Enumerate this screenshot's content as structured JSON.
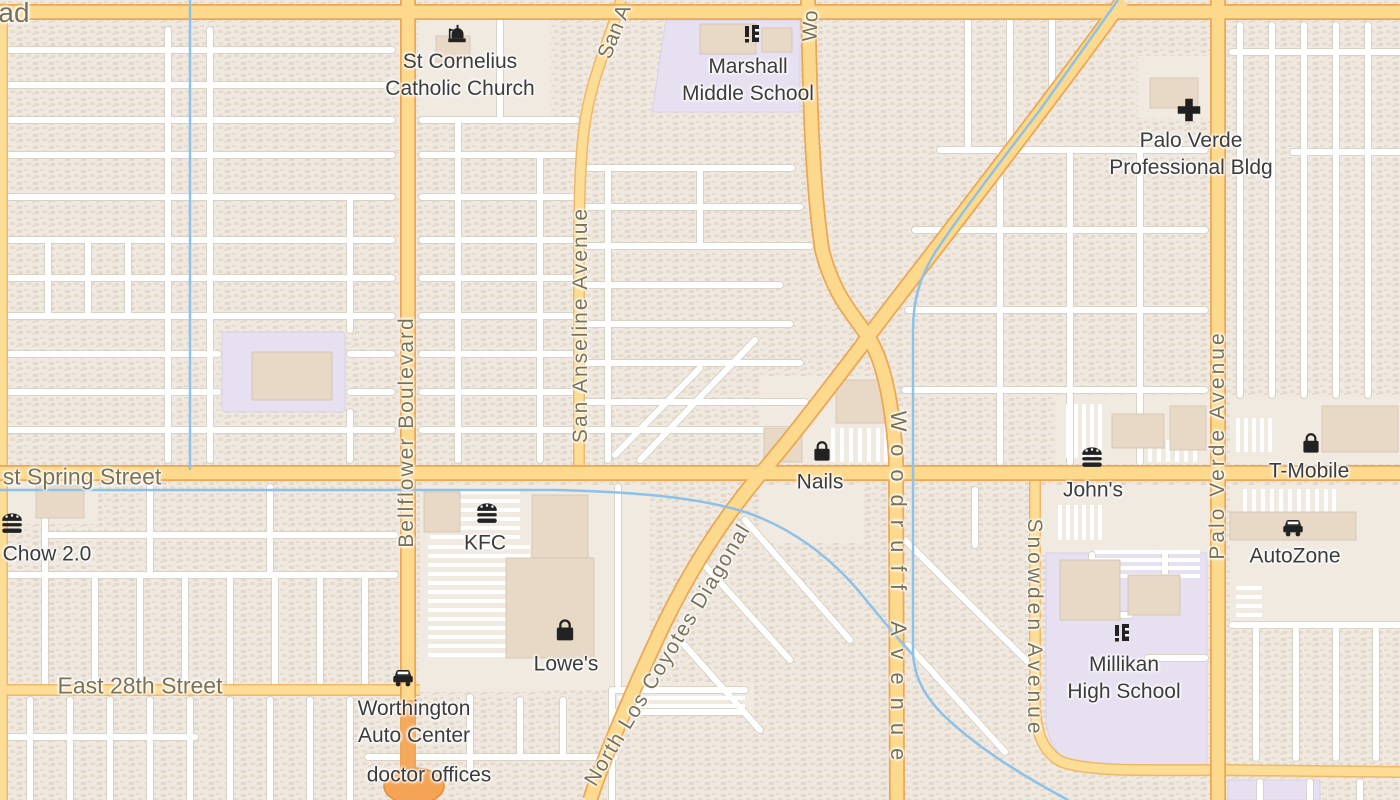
{
  "map": {
    "type": "road-map-tile",
    "colors": {
      "land": "#f1ece4",
      "residential_block": "#efe9e1",
      "residential_speckle": "#e2d8c9",
      "plaza": "#f0eae1",
      "building": "#e8d9c6",
      "school_area": "#e7e0f1",
      "arterial_fill": "#fcd98c",
      "arterial_casing": "#eda653",
      "collector_fill": "#fcdd96",
      "collector_casing": "#f0b768",
      "minor_road": "#ffffff",
      "minor_casing": "#d8d2c7",
      "water": "#8ec1e8",
      "road_label": "#7a7257",
      "poi_label": "#3c3c3c",
      "bridge_overlay": "#f5a95c"
    },
    "road_labels": {
      "top_left_partial": "ad",
      "spring_street": "st Spring Street",
      "east_28th_street": "East 28th Street",
      "bellflower": "Bellflower Boulevard",
      "san_anseline": "San Anseline Avenue",
      "san_anseline_partial": "San A",
      "woodruff": "Woodruff Avenue",
      "woodruff_partial": "Wo",
      "snowden": "Snowden Avenue",
      "palo_verde": "Palo Verde Avenue",
      "los_coyotes": "North Los Coyotes Diagonal"
    },
    "pois": {
      "st_cornelius": {
        "line1": "St Cornelius",
        "line2": "Catholic Church",
        "icon": "church-icon"
      },
      "marshall": {
        "line1": "Marshall",
        "line2": "Middle School",
        "icon": "school-icon"
      },
      "palo_verde_bldg": {
        "line1": "Palo Verde",
        "line2": "Professional Bldg",
        "icon": "medical-cross-icon"
      },
      "nails": {
        "name": "Nails",
        "icon": "shopping-bag-icon"
      },
      "johns": {
        "name": "John's",
        "icon": "restaurant-icon"
      },
      "tmobile": {
        "name": "T-Mobile",
        "icon": "shopping-bag-icon"
      },
      "autozone": {
        "name": "AutoZone",
        "icon": "car-icon"
      },
      "kfc": {
        "name": "KFC",
        "icon": "restaurant-icon"
      },
      "lowes": {
        "name": "Lowe's",
        "icon": "shopping-bag-icon"
      },
      "chow": {
        "name": "Chow 2.0",
        "icon": "restaurant-icon"
      },
      "millikan": {
        "line1": "Millikan",
        "line2": "High School",
        "icon": "school-icon"
      },
      "worthington": {
        "line1": "Worthington",
        "line2": "Auto Center",
        "icon": "car-icon"
      },
      "doctor_offices": {
        "name": "doctor offices"
      }
    }
  }
}
